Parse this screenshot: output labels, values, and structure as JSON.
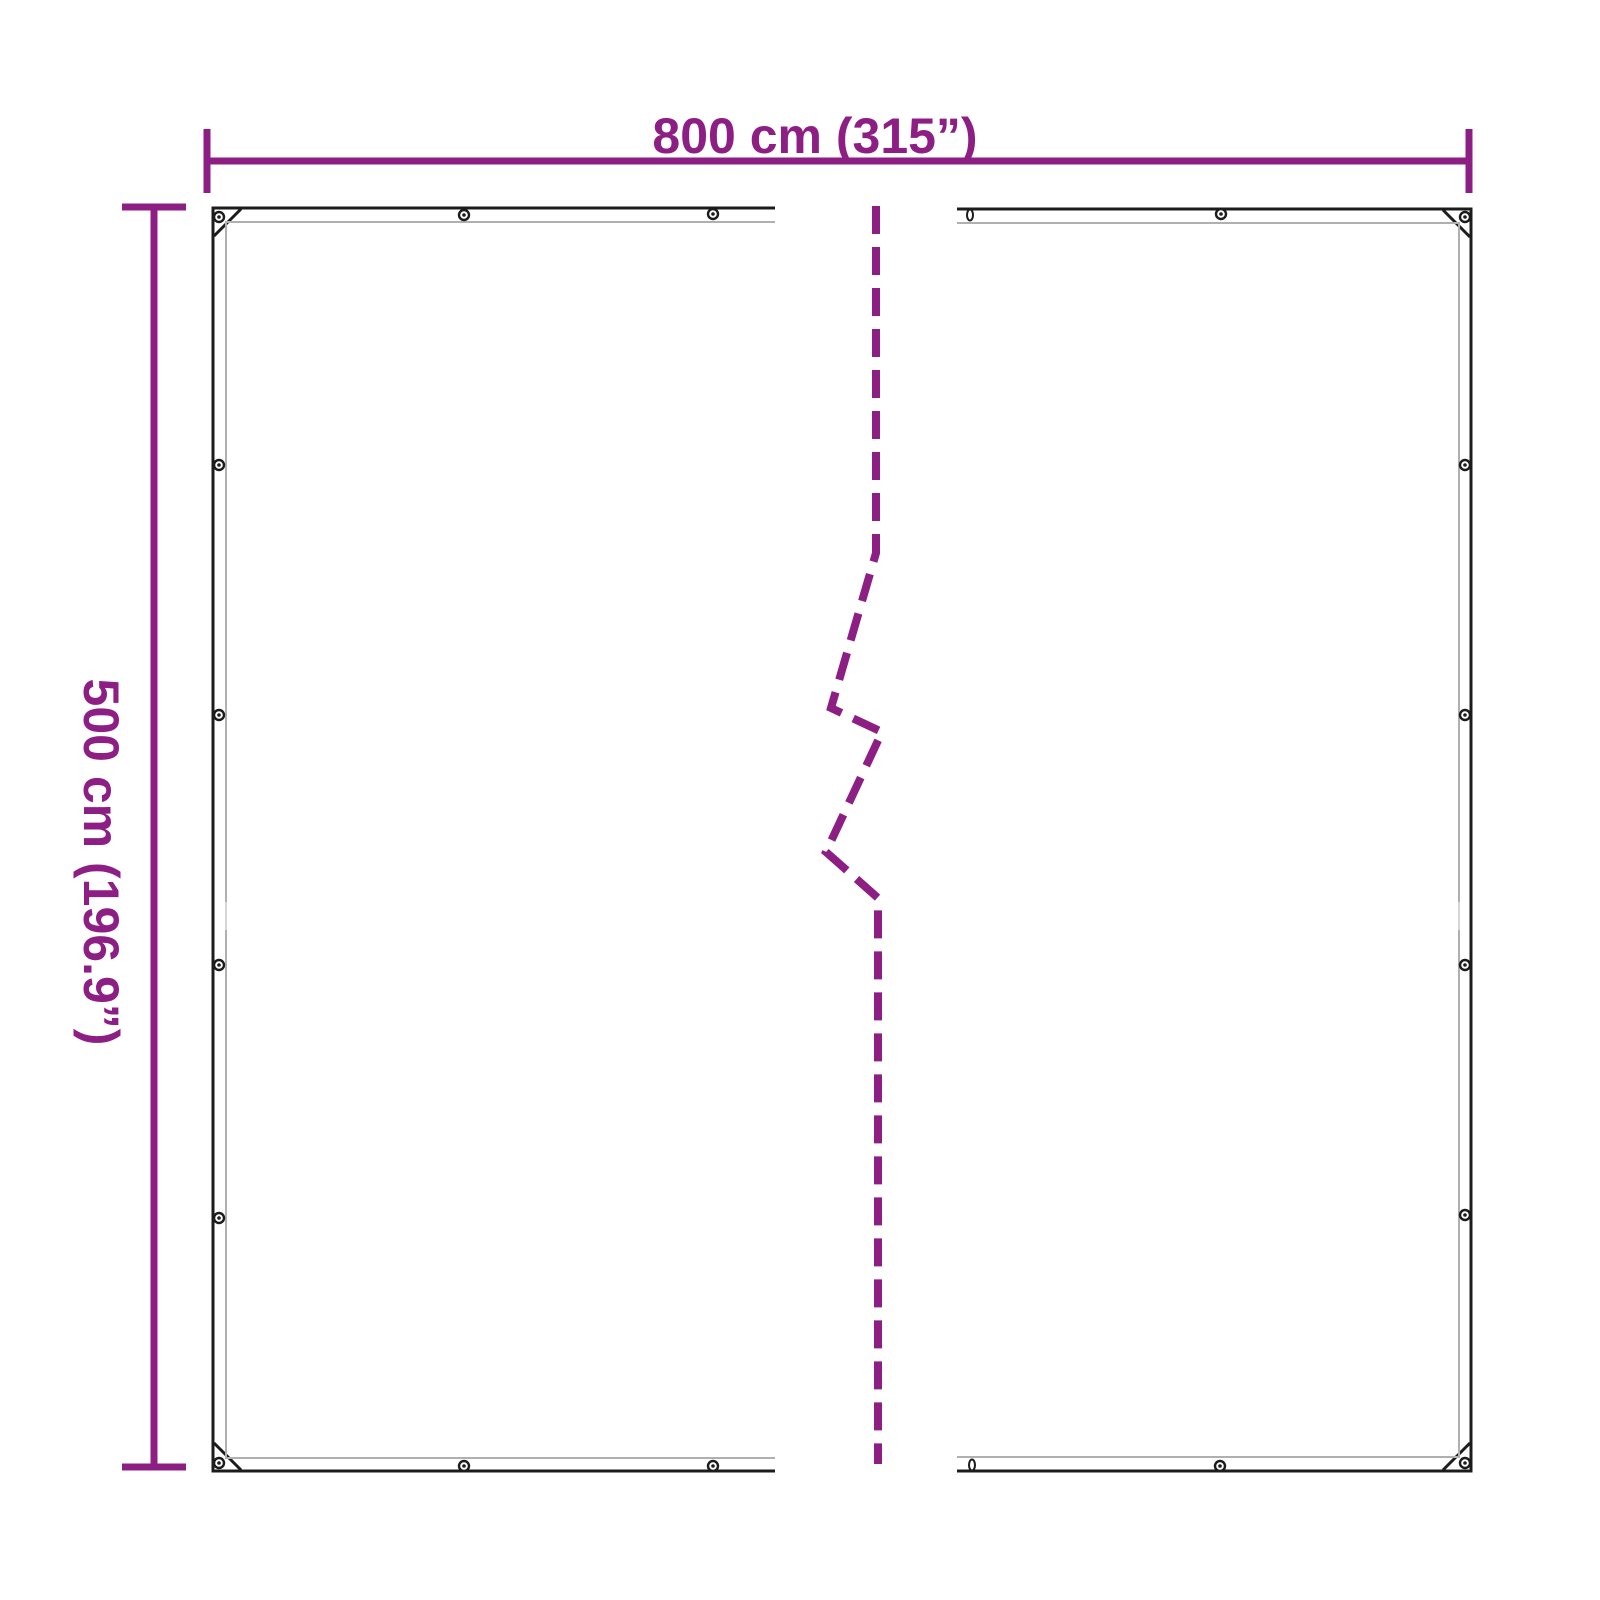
{
  "page": {
    "background": "#ffffff"
  },
  "colors": {
    "accent": "#8D1E83",
    "outline": "#1c1c1c",
    "hem": "#b0b0b0",
    "seam": "#d6d6d6",
    "grommet_fill": "#ffffff"
  },
  "diagram": {
    "type": "product-dimension-diagram",
    "subject": "tarpaulin-with-grommets-and-break-line",
    "dimensions": {
      "width": {
        "label": "800 cm (315”)",
        "value_cm": 800,
        "value_inch": 315
      },
      "height": {
        "label": "500 cm (196.9”)",
        "value_cm": 500,
        "value_inch": 196.9
      }
    }
  }
}
